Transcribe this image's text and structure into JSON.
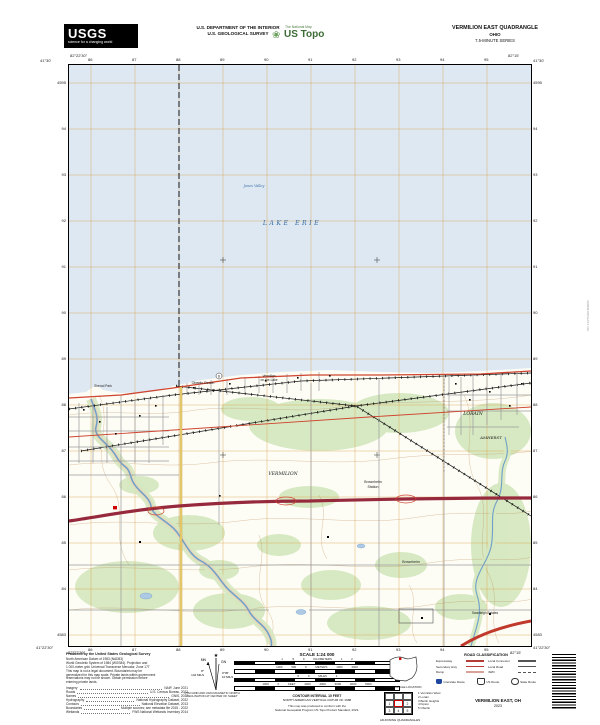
{
  "header": {
    "usgs_word": "USGS",
    "usgs_tagline": "science for a changing world",
    "dept_line1": "U.S. DEPARTMENT OF THE INTERIOR",
    "dept_line2": "U.S. GEOLOGICAL SURVEY",
    "ustopo_national_map": "The National Map",
    "ustopo_brand": "US Topo",
    "ustopo_flower": "❀",
    "quad_title": "VERMILION EAST QUADRANGLE",
    "quad_state": "OHIO",
    "quad_series": "7.5-MINUTE SERIES"
  },
  "margins": {
    "top_ticks": [
      "86",
      "87",
      "88",
      "89",
      "90",
      "91",
      "92",
      "93",
      "94",
      "95"
    ],
    "bottom_ticks": [
      "86",
      "87",
      "88",
      "89",
      "90",
      "91",
      "92",
      "93",
      "94",
      "95"
    ],
    "left_ticks": [
      "4595",
      "94",
      "93",
      "92",
      "91",
      "90",
      "89",
      "88",
      "87",
      "86",
      "85",
      "84",
      "4583"
    ],
    "right_ticks": [
      "4595",
      "94",
      "93",
      "92",
      "91",
      "90",
      "89",
      "88",
      "87",
      "86",
      "85",
      "84",
      "4583"
    ],
    "nw_lat": "41°30'",
    "nw_lon": "82°22'30\"",
    "ne_lat": "41°30'",
    "ne_lon": "82°15'",
    "sw_lat": "41°22'30\"",
    "sw_lon": "82°22'30\"",
    "se_lat": "41°22'30\"",
    "se_lon": "82°15'"
  },
  "map": {
    "labels": {
      "lake": "LAKE ERIE",
      "jones_valley": "Jones Valley",
      "sherod_park": "Sherod Park",
      "oberlin_beach": "Oberlin Beach",
      "votl1": "Vermilion",
      "votl2": "on-the-Lake",
      "lorain": "LORAIN",
      "amherst": "AMHERST",
      "vermilion_twp": "VERMILION",
      "brownhelm1": "Brownhelm",
      "brownhelm2": "Station",
      "brownhelm": "Brownhelm",
      "swanleigh": "Swanleigh Estates",
      "us6": "6"
    }
  },
  "footer": {
    "produced_by": "Produced by the United States Geological Survey",
    "fineprint": [
      "North American Datum of 1983 (NAD83)",
      "World Geodetic System of 1984 (WGS84).  Projection and",
      "1 000-meter grid: Universal Transverse Mercator, Zone 17T",
      "This map is not a legal document. Boundaries may be",
      "generalized for this map scale. Private lands within government",
      "reservations may not be shown. Obtain permission before",
      "entering private lands."
    ],
    "sources": [
      [
        "Imagery",
        "NAIP, June 2021"
      ],
      [
        "Roads",
        "U.S. Census Bureau, 2022"
      ],
      [
        "Names",
        "GNIS, 2022"
      ],
      [
        "Hydrography",
        "National Hydrography Dataset, 2022"
      ],
      [
        "Contours",
        "National Elevation Dataset, 2013"
      ],
      [
        "Boundaries",
        "Multiple sources; see metadata file 2015 - 2022"
      ],
      [
        "Wetlands",
        "FWS National Wetlands Inventory 2014"
      ]
    ],
    "declination": {
      "gn": "GN",
      "mn": "MN",
      "star": "★",
      "gn_deg": "0°35'",
      "gn_mils": "10 MILS",
      "mn_deg": "8°",
      "mn_mils": "142 MILS",
      "cap1": "UTM GRID AND 2023 MAGNETIC NORTH",
      "cap2": "DECLINATION AT CENTER OF SHEET"
    },
    "scale": {
      "title": "SCALE 1:24 000",
      "km_nums": "1 .5 0 KILOMETERS 1 2",
      "m_nums": "1000 500 0 METERS 1000 2000",
      "mi_nums": ".5 0 MILES 1",
      "ft_nums": "1000 0 FEET 1000 2000 3000 4000 5000",
      "contour1": "CONTOUR INTERVAL 10 FEET",
      "contour2": "NORTH AMERICAN VERTICAL DATUM OF 1988",
      "std1": "This map was produced to conform with the",
      "std2": "National Geospatial Program US Topo Product Standard, 2023."
    },
    "location_caption": "QUADRANGLE LOCATION",
    "adjoining_caption": "ADJOINING QUADRANGLES",
    "adjoining_cells": [
      "",
      "",
      "",
      "1",
      "",
      "2",
      "3",
      "4",
      "5"
    ],
    "adjoining_list": [
      "1 Vermilion West",
      "2 Lorain",
      "3 Berlin Heights",
      "4 Kipton",
      "5 Oberlin"
    ],
    "road_class": {
      "title": "ROAD CLASSIFICATION",
      "left_rows": [
        "Expressway",
        "Secondary Hwy",
        "Ramp"
      ],
      "right_rows": [
        "Local Connector",
        "Local Road",
        "4WD"
      ],
      "shields": [
        "Interstate Route",
        "US Route",
        "State Route"
      ]
    },
    "map_name": "VERMILION EAST, OH",
    "map_year": "2023",
    "edge_note": "VERMILION EAST, OH"
  },
  "colors": {
    "lake": "#dde8f2",
    "grid_orange": "#d99a3d",
    "woodland": "#d6e8c0",
    "contour": "#b5824a",
    "road_red": "#cf4531",
    "turnpike": "#97293d",
    "water_blue": "#6f9fc8",
    "lake_label": "#3b6ea5"
  }
}
